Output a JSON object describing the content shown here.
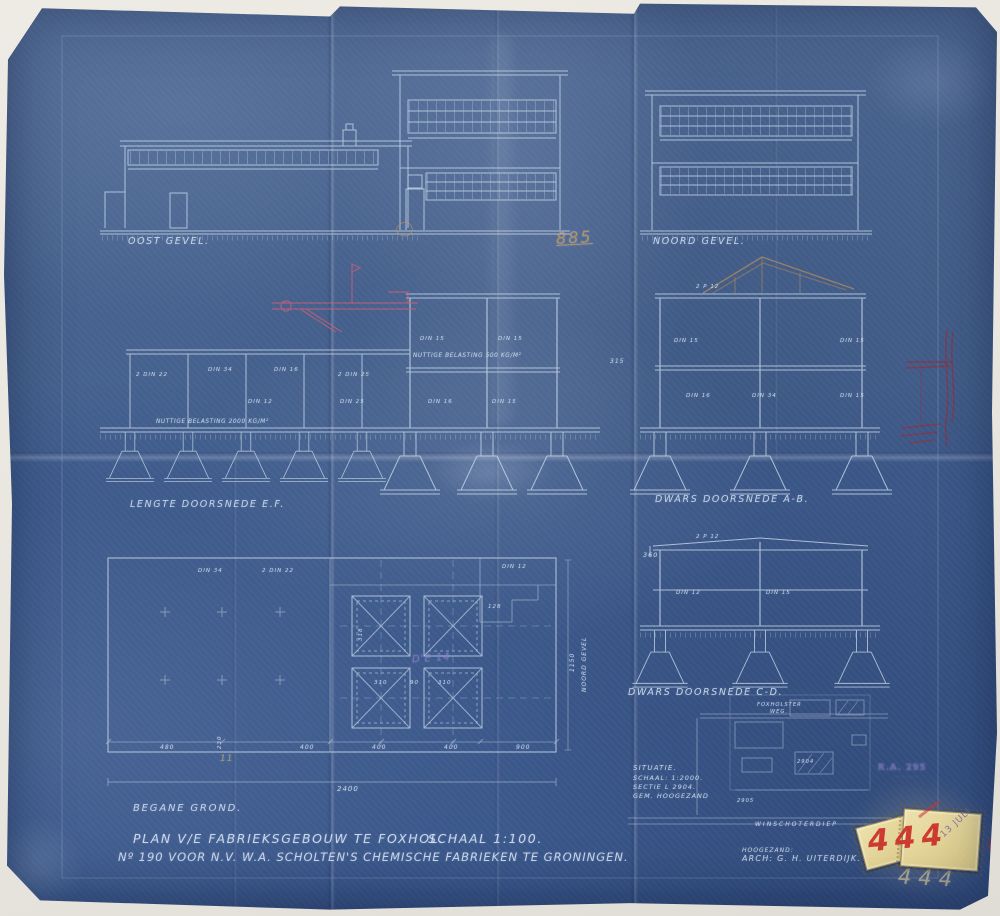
{
  "sheet": {
    "drawings": {
      "oost_label": "OOST GEVEL.",
      "noord_label": "NOORD GEVEL.",
      "lengte_label": "LENGTE DOORSNEDE E.F.",
      "dwars_ab_label": "DWARS DOORSNEDE A-B.",
      "dwars_cd_label": "DWARS DOORSNEDE C-D.",
      "plan_label": "BEGANE GROND.",
      "plan_side_note": "NOORD GEVEL"
    },
    "notes": {
      "load_upper": "NUTTIGE BELASTING 500 KG/M²",
      "load_lower": "NUTTIGE BELASTING 2000 KG/M²"
    },
    "members": {
      "m0": "2 DIN 22",
      "m1": "DIN 34",
      "m2": "DIN 16",
      "m3": "2 DIN 25",
      "m4": "DIN 15",
      "m5": "DIN 15",
      "m6": "DIN 12",
      "m7": "DIN 25",
      "m8": "DIN 16",
      "m9": "DIN 15",
      "m10": "2 P 12",
      "m11": "DIN 15",
      "m12": "DIN 15",
      "m13": "DIN 16",
      "m14": "DIN 34",
      "m15": "DIN 15",
      "m16": "2 P 12",
      "m17": "DIN 12",
      "m18": "DIN 15",
      "m19": "DIN 34",
      "m20": "2 DIN 22",
      "m21": "DIN 12"
    },
    "dims": {
      "total": "2400",
      "right_side": "1150",
      "cd_height": "360",
      "p480": "480",
      "p230": "230",
      "p400a": "400",
      "p400b": "400",
      "p400c": "400",
      "p900": "900",
      "sq310a": "310",
      "sq90": "90",
      "sq310b": "310",
      "sq318": "318",
      "sq128": "128",
      "ab315": "315"
    },
    "situatie": {
      "title": "SITUATIE.",
      "scale": "SCHAAL: 1:2000.",
      "sectie": "SECTIE L 2904.",
      "gemeente": "GEM. HOOGEZAND",
      "road1": "FOXHOLSTER",
      "road2": "WEG.",
      "canal": "WINSCHOTERDIEP",
      "num1": "2904",
      "num2": "2905"
    },
    "title_block": {
      "line1a": "PLAN V/E FABRIEKSGEBOUW TE FOXHOL.",
      "line1b": "SCHAAL 1:100.",
      "line2": "Nº 190 VOOR N.V. W.A. SCHOLTEN'S CHEMISCHE FABRIEKEN TE GRONINGEN."
    },
    "signature": {
      "place": "HOOGEZAND:",
      "architect": "ARCH: G. H. UITERDIJK."
    }
  },
  "marks": {
    "orange_note": "885",
    "plan_note": "D'E 14",
    "tan_note": "11",
    "stamp_number": "444",
    "stamp_date": "13 JULI",
    "pencil_number": "444",
    "archive_line1": "R.A. 295",
    "archive_line2": "········"
  },
  "colors": {
    "paper": "#42608e",
    "linework": "#c8d8ea",
    "red_pencil": "#c95f76",
    "sepia": "#b98e58",
    "stamp_red": "#cb2d26",
    "stamp_purple": "#7e5fa6",
    "label_paper": "#e7dba4",
    "pencil": "#d6c795"
  }
}
